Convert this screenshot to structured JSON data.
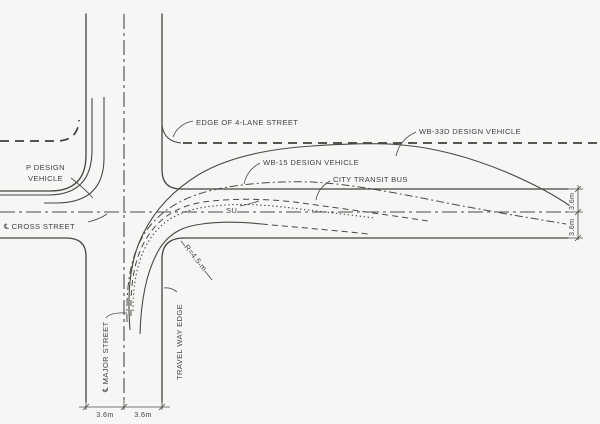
{
  "colors": {
    "ink": "#45453f",
    "background": "#f6f6f4"
  },
  "labels": {
    "edge_4lane": "EDGE OF 4-LANE STREET",
    "wb33d": "WB-33D DESIGN VEHICLE",
    "wb15": "WB-15 DESIGN VEHICLE",
    "city_transit_bus": "CITY TRANSIT BUS",
    "su": "SU",
    "p_design_line1": "P DESIGN",
    "p_design_line2": "VEHICLE",
    "cross_street": "℄ CROSS STREET",
    "major_street": "℄ MAJOR STREET",
    "travel_way_edge": "TRAVEL WAY EDGE",
    "radius": "R=4.5 m"
  },
  "dimensions": {
    "bottom_left_lane": "3.6m",
    "bottom_right_lane": "3.6m",
    "right_upper_lane": "3.6m",
    "right_lower_lane": "3.6m"
  }
}
